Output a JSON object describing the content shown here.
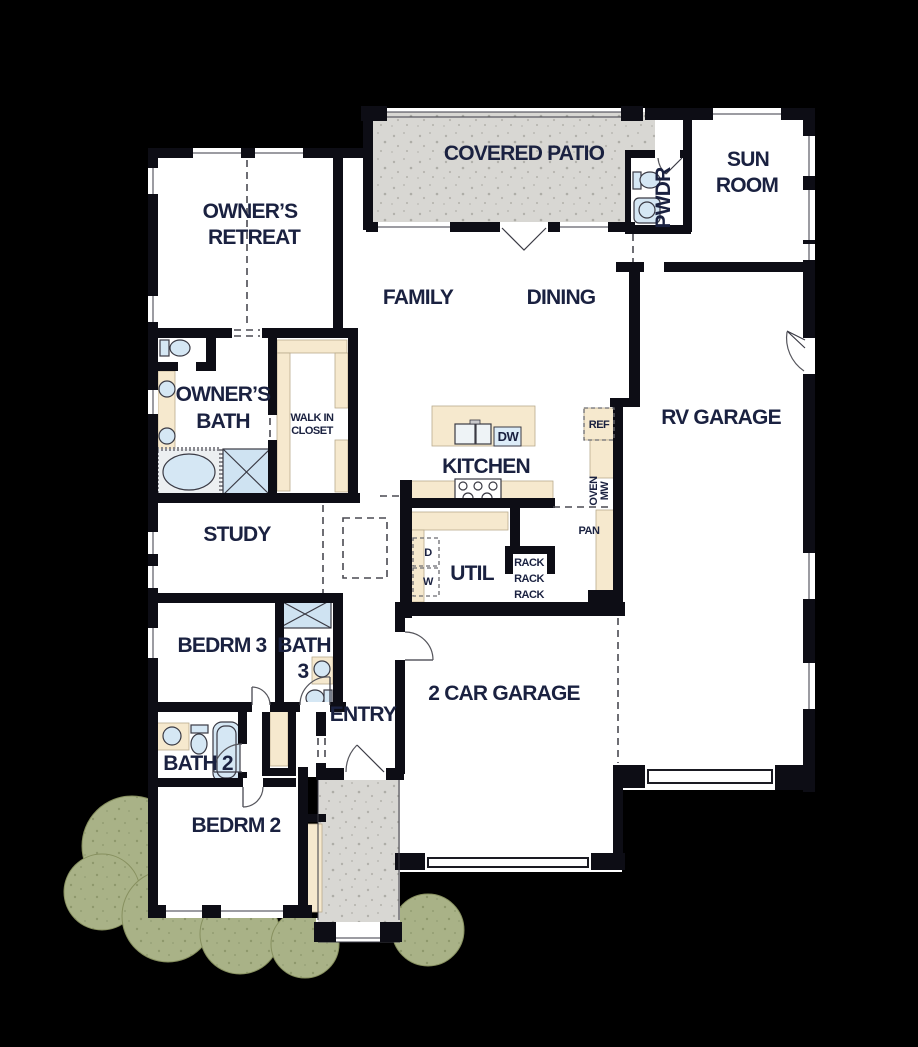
{
  "plan": {
    "title": "Single-story floor plan",
    "rooms": {
      "covered_patio": "COVERED PATIO",
      "sun_room": [
        "SUN",
        "ROOM"
      ],
      "pwdr": "PWDR",
      "owners_retreat": [
        "OWNER’S",
        "RETREAT"
      ],
      "family": "FAMILY",
      "dining": "DINING",
      "rv_garage": "RV GARAGE",
      "owners_bath": [
        "OWNER’S",
        "BATH"
      ],
      "walk_in_closet": [
        "WALK IN",
        "CLOSET"
      ],
      "kitchen": "KITCHEN",
      "study": "STUDY",
      "util": "UTIL",
      "bedrm3": "BEDRM 3",
      "bath3": [
        "BATH",
        "3"
      ],
      "entry": "ENTRY",
      "two_car_garage": "2 CAR GARAGE",
      "bath2": "BATH 2",
      "bedrm2": "BEDRM 2"
    },
    "appliances": {
      "dw": "DW",
      "ref": "REF",
      "oven": "OVEN",
      "mw": "MW",
      "pan": "PAN",
      "dryer": "D",
      "washer": "W",
      "rack": "RACK"
    },
    "colors": {
      "background": "#000000",
      "floor": "#ffffff",
      "wall": "#0d0d15",
      "patio": "#d8d7d3",
      "cabinetry": "#f6e9ce",
      "fixture": "#d5e7f4",
      "foliage": "#a9b287",
      "label_text": "#1a2140"
    }
  }
}
